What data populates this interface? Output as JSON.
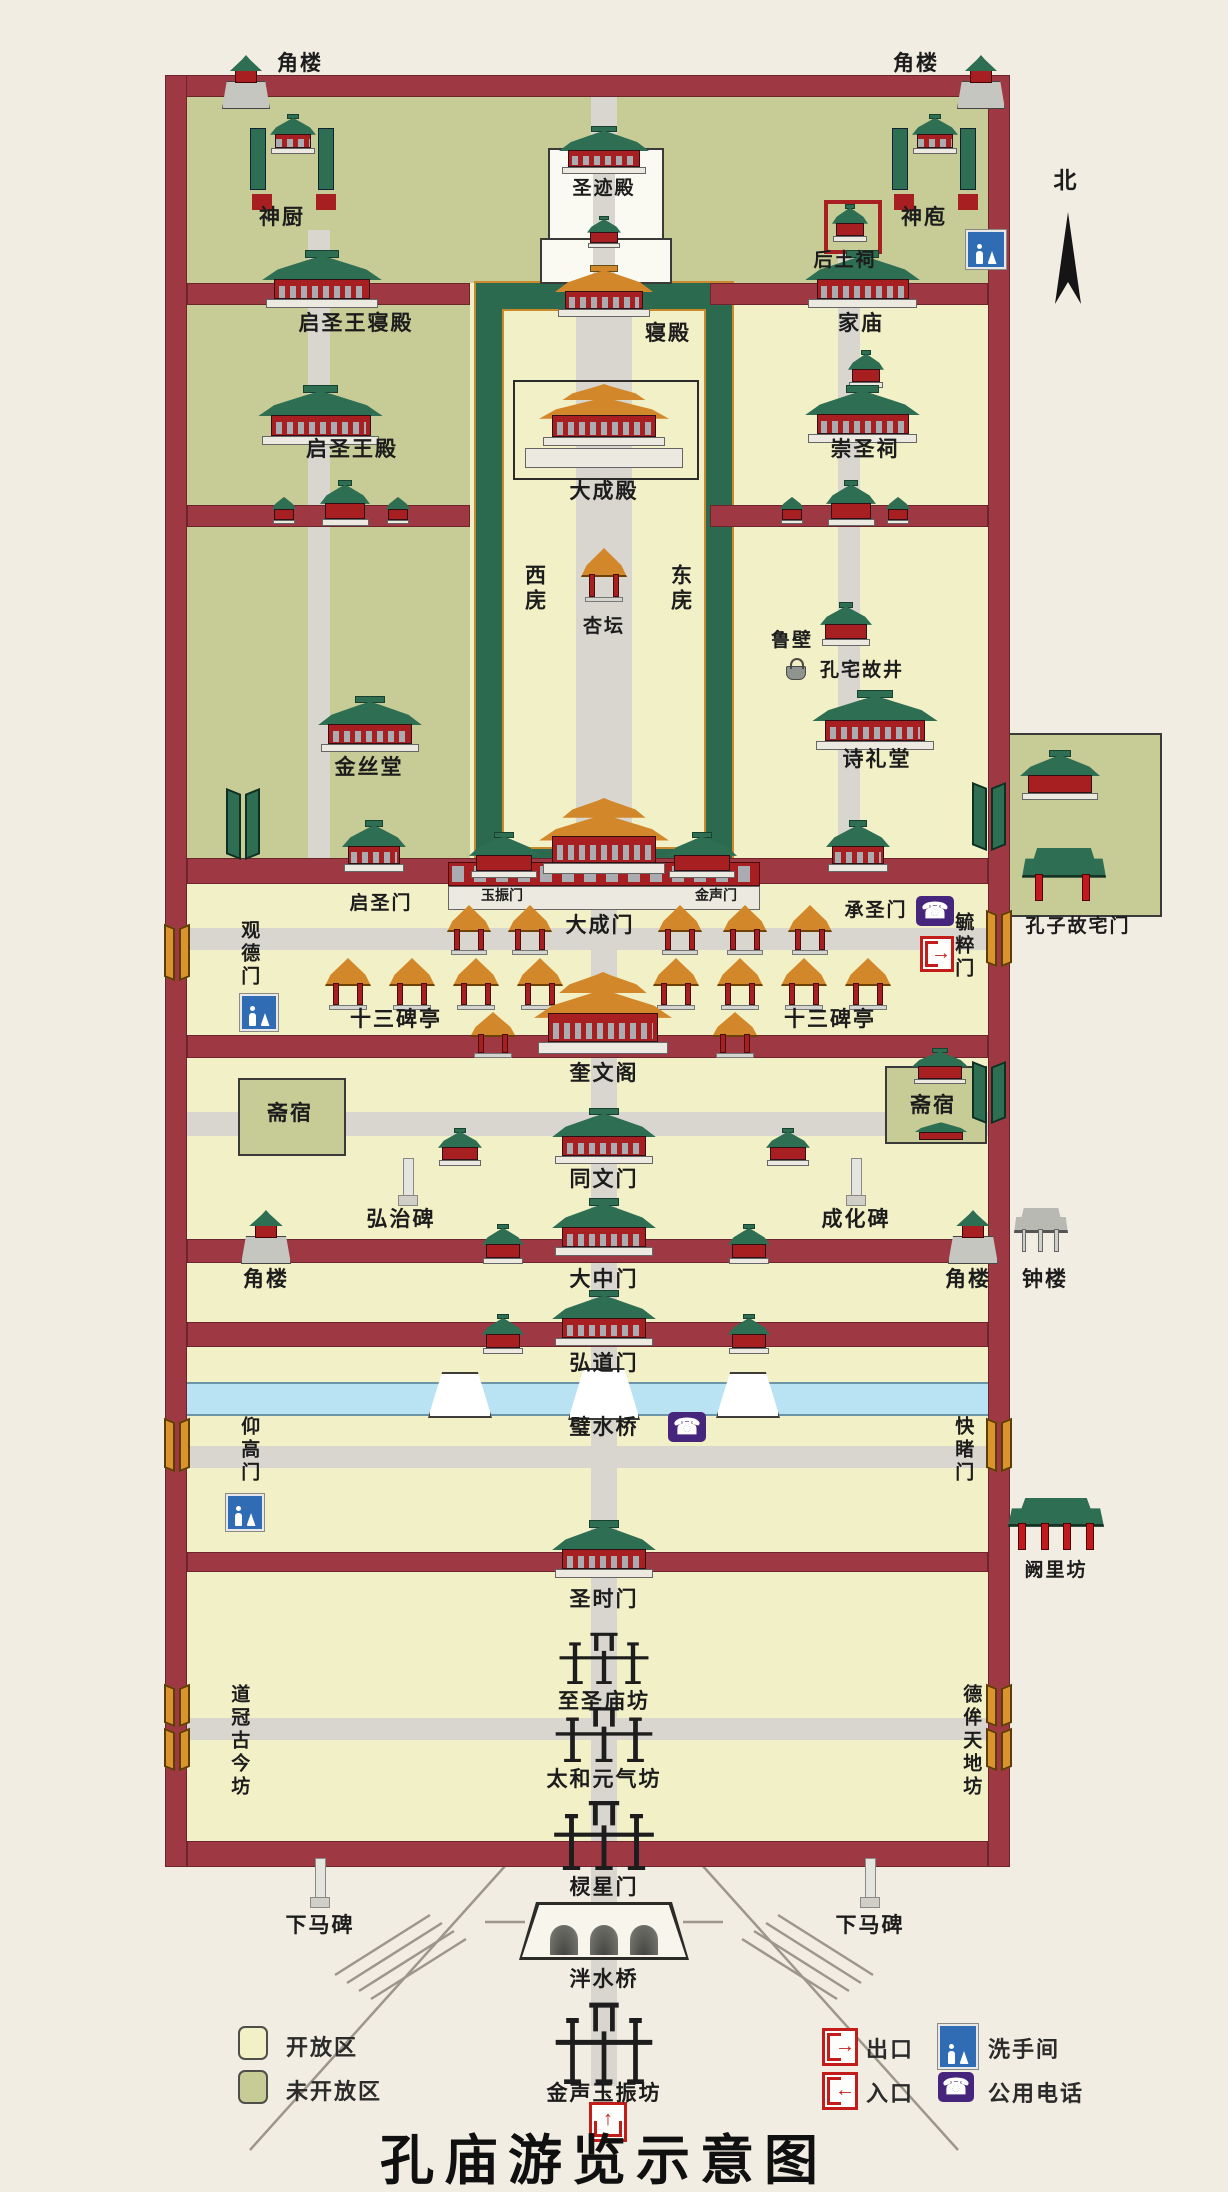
{
  "title": "孔庙游览示意图",
  "compass": {
    "north": "北"
  },
  "palette": {
    "background": "#f2ede2",
    "open_area": "#f2f0c6",
    "closed_area": "#c7cb95",
    "wall": "#9e3843",
    "water": "#b9e3f2",
    "roof_green": "#2e6e52",
    "roof_orange": "#d2882a",
    "body_red": "#a81f22",
    "path_gray": "#d8d6cf",
    "phone_purple": "#46257d",
    "toilet_blue": "#2f6cb4",
    "gate_red": "#c21d1a"
  },
  "legend": {
    "open_area": "开放区",
    "closed_area": "未开放区",
    "exit": "出口",
    "entrance": "入口",
    "restroom": "洗手间",
    "phone": "公用电话"
  },
  "icons": {
    "phone_glyph": "☎",
    "exit_arrow": "→",
    "entrance_arrow": "←",
    "entrance_up": "↑"
  },
  "labels": {
    "corner_tower_tl": "角楼",
    "corner_tower_tr": "角楼",
    "shen_chu": "神厨",
    "sheng_ji_dian": "圣迹殿",
    "hou_tu_ci": "后土祠",
    "shen_pao": "神庖",
    "qi_sheng_wang_qin_dian": "启圣王寝殿",
    "qin_dian": "寝殿",
    "jia_miao": "家庙",
    "qi_sheng_wang_dian": "启圣王殿",
    "da_cheng_dian": "大成殿",
    "chong_sheng_ci": "崇圣祠",
    "xi_wu": "西庑",
    "xing_tan": "杏坛",
    "dong_wu": "东庑",
    "lu_bi": "鲁壁",
    "kong_zhai_gu_jing": "孔宅故井",
    "jin_si_tang": "金丝堂",
    "shi_li_tang": "诗礼堂",
    "qi_sheng_men": "启圣门",
    "yu_zhen_men": "玉振门",
    "da_cheng_men": "大成门",
    "jin_sheng_men": "金声门",
    "cheng_sheng_men": "承圣门",
    "guan_de_men": "观德门",
    "yu_cui_men": "毓粹门",
    "kong_zi_gu_zhai_men": "孔子故宅门",
    "shi_san_bei_ting_l": "十三碑亭",
    "shi_san_bei_ting_r": "十三碑亭",
    "kui_wen_ge": "奎文阁",
    "zhai_su_l": "斋宿",
    "zhai_su_r": "斋宿",
    "tong_wen_men": "同文门",
    "hong_zhi_bei": "弘治碑",
    "cheng_hua_bei": "成化碑",
    "corner_tower_ml": "角楼",
    "da_zhong_men": "大中门",
    "corner_tower_mr": "角楼",
    "zhong_lou": "钟楼",
    "hong_dao_men": "弘道门",
    "bi_shui_qiao": "璧水桥",
    "yang_gao_men": "仰高门",
    "kuai_du_men": "快睹门",
    "que_li_fang": "阙里坊",
    "sheng_shi_men": "圣时门",
    "zhi_sheng_miao_fang": "至圣庙坊",
    "dao_guan_gu_jin_fang": "道冠古今坊",
    "de_mou_tian_di_fang": "德侔天地坊",
    "tai_he_yuan_qi_fang": "太和元气坊",
    "ling_xing_men": "棂星门",
    "xia_ma_bei_l": "下马碑",
    "xia_ma_bei_r": "下马碑",
    "pan_shui_qiao": "泮水桥",
    "jin_sheng_yu_zhen_fang": "金声玉振坊"
  }
}
